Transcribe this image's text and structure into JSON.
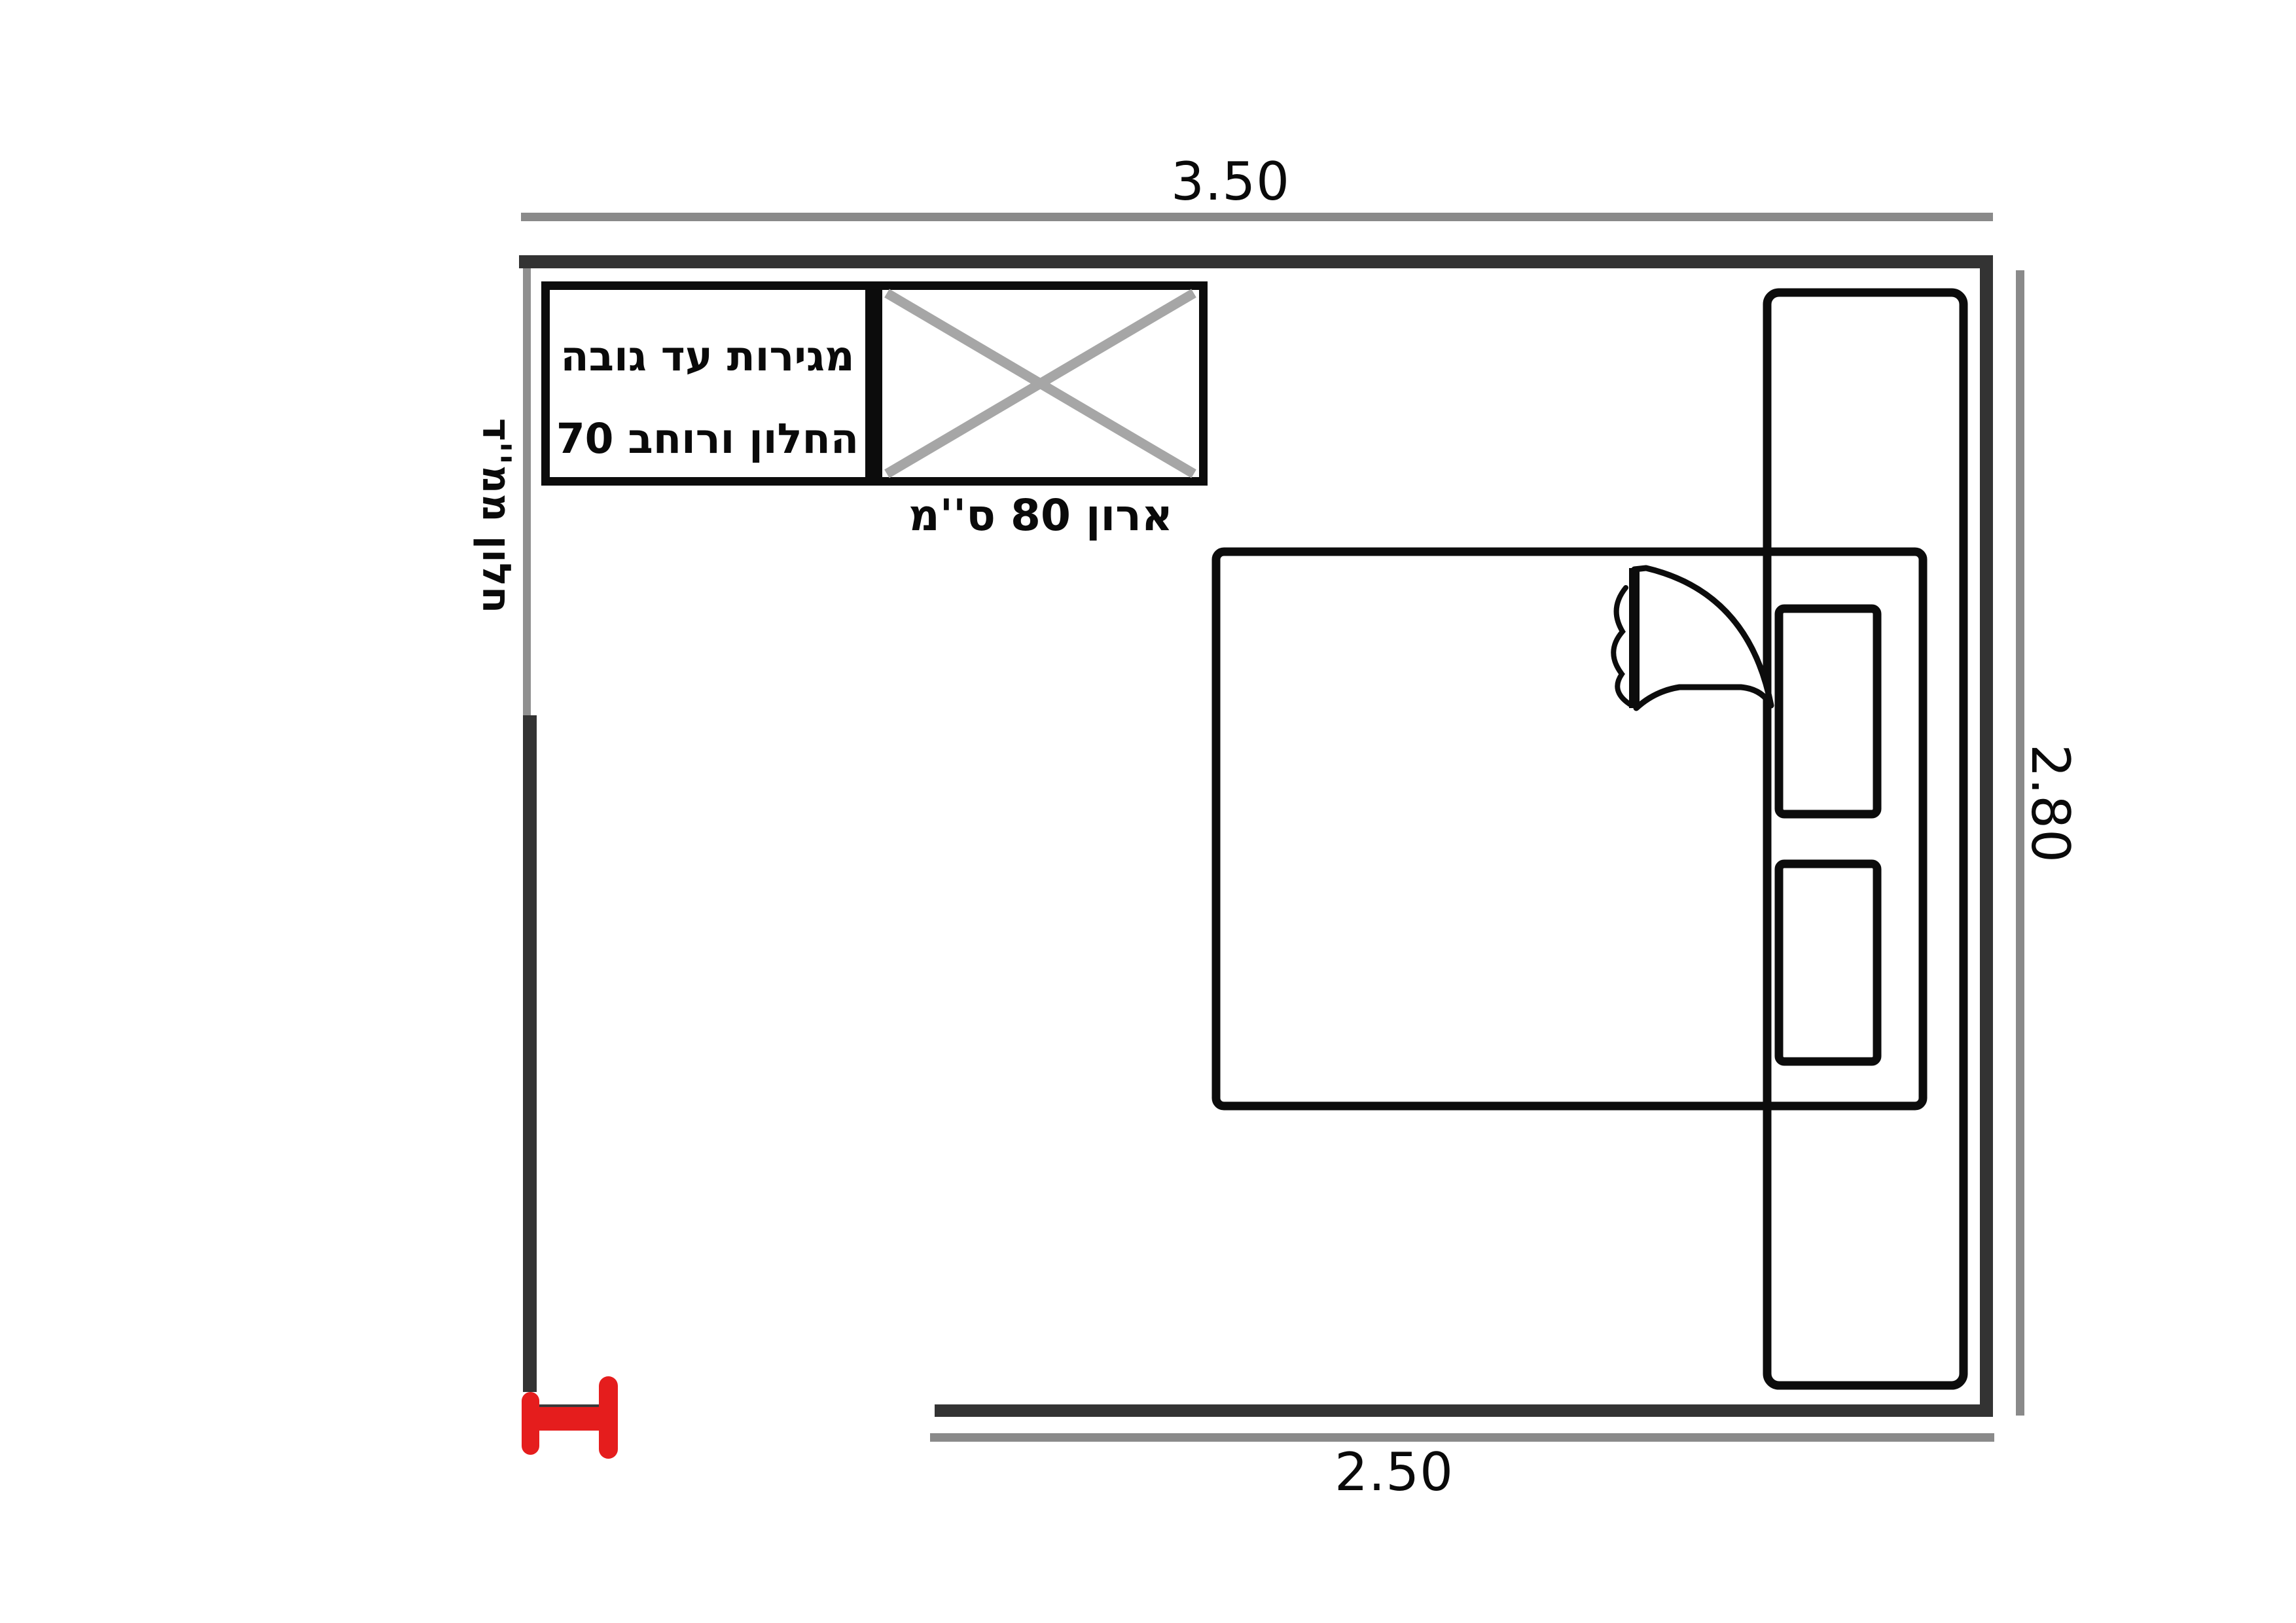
{
  "diagram": {
    "type": "bedroom-floor-plan",
    "dimensions": {
      "top": "3.50",
      "right": "2.80",
      "bottom": "2.50"
    },
    "labels": {
      "drawers_line1": "מגירות עד גובה",
      "drawers_line2": "החלון ורוחב 70",
      "cabinet": "ארון 80 ס''מ",
      "window": "חלון ממ''ד"
    },
    "colors": {
      "wall": "#333333",
      "dimension_line": "#8a8a8a",
      "window_segment": "#8f8f8f",
      "cabinet_x": "#a6a6a6",
      "furniture_ink": "#0c0c0c",
      "door_marker": "#e51d1d"
    }
  }
}
